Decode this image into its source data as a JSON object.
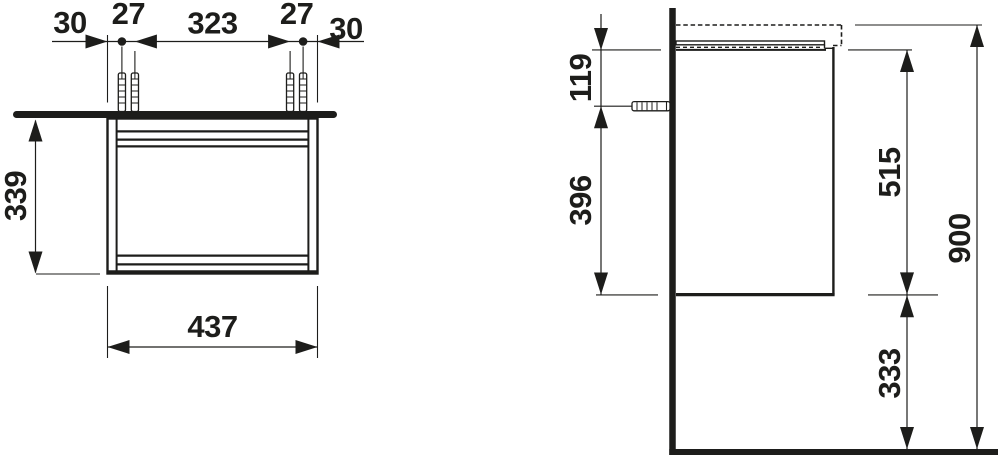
{
  "diagram": {
    "type": "technical-dimension-drawing",
    "views": [
      "front",
      "side"
    ]
  },
  "dimensions": {
    "front": {
      "left_offset": "30",
      "fixing_pitch_left": "27",
      "fixing_span": "323",
      "fixing_pitch_right": "27",
      "right_offset": "30",
      "carcass_height": "339",
      "width": "437"
    },
    "side": {
      "top_to_fixing": "119",
      "fixing_to_bottom": "396",
      "cabinet_height": "515",
      "floor_clearance": "333",
      "overall_height": "900"
    }
  },
  "colors": {
    "line": "#1d1d1b",
    "background": "#ffffff"
  }
}
